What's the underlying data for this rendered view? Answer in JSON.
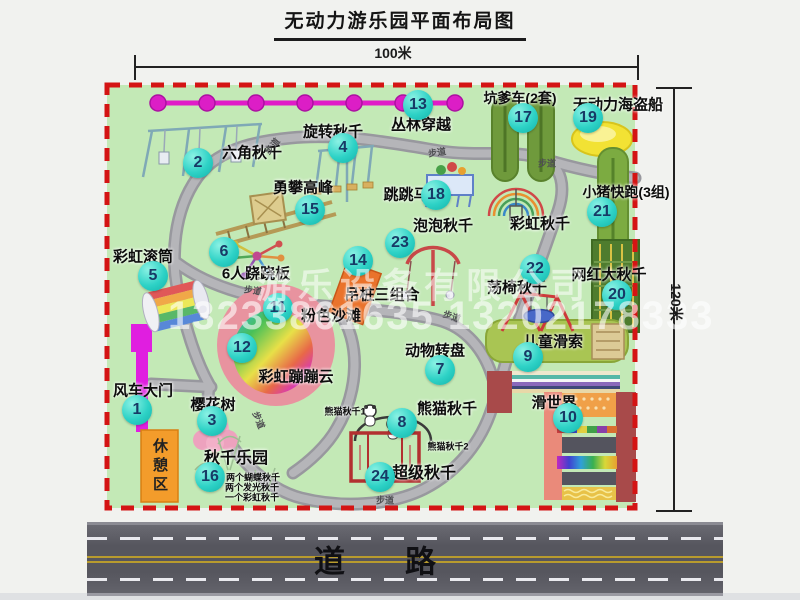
{
  "title": "无动力游乐园平面布局图",
  "dimensions": {
    "width": "100米",
    "height": "120米"
  },
  "road": {
    "label": "道路"
  },
  "watermark": {
    "company": "游乐设备有限公司",
    "phone": "13233861635 13202178333"
  },
  "rest_area": {
    "label": "休憩区"
  },
  "walkway": {
    "label": "步道"
  },
  "attractions": [
    {
      "num": "1",
      "name": "风车大门",
      "badge": [
        137,
        410
      ],
      "label": [
        143,
        390
      ],
      "size": 15
    },
    {
      "num": "2",
      "name": "六角秋千",
      "badge": [
        198,
        163
      ],
      "label": [
        252,
        152
      ],
      "size": 15
    },
    {
      "num": "3",
      "name": "樱花树",
      "badge": [
        212,
        421
      ],
      "label": [
        213,
        404
      ],
      "size": 15
    },
    {
      "num": "4",
      "name": "旋转秋千",
      "badge": [
        343,
        148
      ],
      "label": [
        333,
        131
      ],
      "size": 15
    },
    {
      "num": "5",
      "name": "彩虹滚筒",
      "badge": [
        153,
        276
      ],
      "label": [
        143,
        256
      ],
      "size": 15
    },
    {
      "num": "6",
      "name": "6人跷跷板",
      "badge": [
        224,
        252
      ],
      "label": [
        256,
        273
      ],
      "size": 15
    },
    {
      "num": "7",
      "name": "动物转盘",
      "badge": [
        440,
        370
      ],
      "label": [
        435,
        350
      ],
      "size": 15
    },
    {
      "num": "8",
      "name": "熊猫秋千",
      "badge": [
        402,
        423
      ],
      "label": [
        447,
        408
      ],
      "size": 15
    },
    {
      "num": "9",
      "name": "儿童滑索",
      "badge": [
        528,
        357
      ],
      "label": [
        553,
        341
      ],
      "size": 15
    },
    {
      "num": "10",
      "name": "滑世界",
      "badge": [
        568,
        418
      ],
      "label": [
        554,
        402
      ],
      "size": 15
    },
    {
      "num": "11",
      "name": "粉色沙滩",
      "badge": [
        278,
        308
      ],
      "label": [
        331,
        315
      ],
      "size": 15
    },
    {
      "num": "12",
      "name": "彩虹蹦蹦云",
      "badge": [
        242,
        348
      ],
      "label": [
        296,
        376
      ],
      "size": 15
    },
    {
      "num": "13",
      "name": "丛林穿越",
      "badge": [
        418,
        105
      ],
      "label": [
        421,
        124
      ],
      "size": 15
    },
    {
      "num": "14",
      "name": "吊桩三组合",
      "badge": [
        358,
        261
      ],
      "label": [
        382,
        294
      ],
      "size": 15
    },
    {
      "num": "15",
      "name": "勇攀高峰",
      "badge": [
        310,
        210
      ],
      "label": [
        303,
        187
      ],
      "size": 15
    },
    {
      "num": "16",
      "name": "秋千乐园",
      "badge": [
        210,
        477
      ],
      "label": [
        236,
        456
      ],
      "size": 16
    },
    {
      "num": "17",
      "name": "坑爹车(2套)",
      "badge": [
        523,
        118
      ],
      "label": [
        520,
        98
      ],
      "size": 14
    },
    {
      "num": "18",
      "name": "跳跳马",
      "badge": [
        436,
        195
      ],
      "label": [
        406,
        194
      ],
      "size": 15
    },
    {
      "num": "19",
      "name": "无动力海盗船",
      "badge": [
        588,
        118
      ],
      "label": [
        618,
        104
      ],
      "size": 15
    },
    {
      "num": "20",
      "name": "网红大秋千",
      "badge": [
        617,
        295
      ],
      "label": [
        609,
        274
      ],
      "size": 15
    },
    {
      "num": "21",
      "name": "小猪快跑(3组)",
      "badge": [
        602,
        212
      ],
      "label": [
        626,
        192
      ],
      "size": 14
    },
    {
      "num": "22",
      "name": "荡椅秋千",
      "badge": [
        535,
        269
      ],
      "label": [
        517,
        287
      ],
      "size": 15
    },
    {
      "num": "23",
      "name": "泡泡秋千",
      "badge": [
        400,
        243
      ],
      "label": [
        443,
        225
      ],
      "size": 15
    },
    {
      "num": "24",
      "name": "超级秋千",
      "badge": [
        380,
        477
      ],
      "label": [
        424,
        471
      ],
      "size": 16
    }
  ],
  "extra_labels": [
    {
      "text": "彩虹秋千",
      "x": 540,
      "y": 223,
      "size": 15
    },
    {
      "text": "熊猫秋千1",
      "x": 345,
      "y": 411,
      "size": 9
    },
    {
      "text": "熊猫秋千2",
      "x": 448,
      "y": 446,
      "size": 9
    },
    {
      "text": "两个蝴蝶秋千",
      "x": 253,
      "y": 477,
      "size": 9
    },
    {
      "text": "两个发光秋千",
      "x": 252,
      "y": 487,
      "size": 9
    },
    {
      "text": "一个彩虹秋千",
      "x": 252,
      "y": 497,
      "size": 9
    }
  ],
  "walkway_positions": [
    {
      "x": 272,
      "y": 146,
      "r": -50
    },
    {
      "x": 437,
      "y": 152,
      "r": -8
    },
    {
      "x": 547,
      "y": 163,
      "r": 0
    },
    {
      "x": 253,
      "y": 290,
      "r": 8
    },
    {
      "x": 452,
      "y": 316,
      "r": 18
    },
    {
      "x": 259,
      "y": 420,
      "r": 68
    },
    {
      "x": 385,
      "y": 500,
      "r": 0
    }
  ]
}
